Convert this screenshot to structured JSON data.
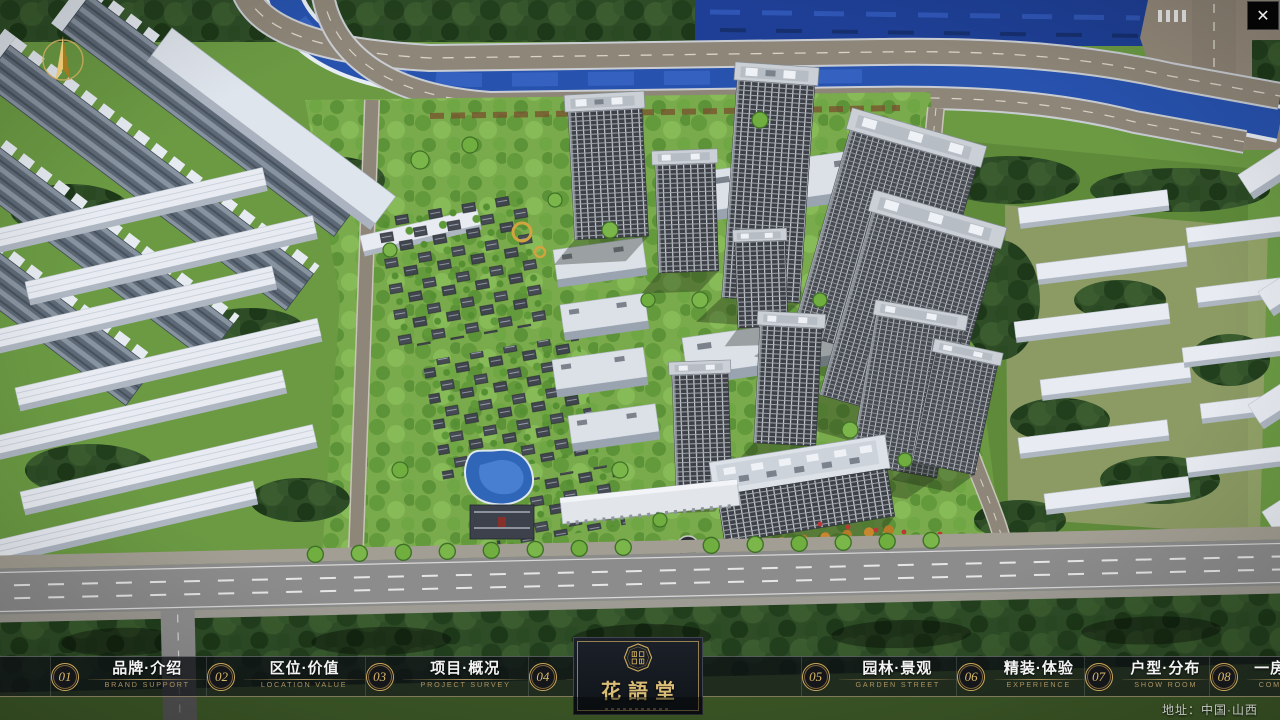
{
  "window": {
    "close_icon": "✕"
  },
  "map": {
    "address_note": "地址：中国·山西"
  },
  "logo": {
    "title": "花語堂"
  },
  "menu": {
    "items": [
      {
        "num": "01",
        "cn": "品牌·介绍",
        "en": "BRAND SUPPORT"
      },
      {
        "num": "02",
        "cn": "区位·价值",
        "en": "LOCATION VALUE"
      },
      {
        "num": "03",
        "cn": "项目·概况",
        "en": "PROJECT SURVEY"
      },
      {
        "num": "04",
        "cn": "建筑·鉴赏",
        "en": "APPRECIATION"
      },
      {
        "num": "05",
        "cn": "园林·景观",
        "en": "GARDEN STREET"
      },
      {
        "num": "06",
        "cn": "精装·体验",
        "en": "EXPERIENCE"
      },
      {
        "num": "07",
        "cn": "户型·分布",
        "en": "SHOW ROOM"
      },
      {
        "num": "08",
        "cn": "一房·一景",
        "en": "COMMUNITY"
      }
    ]
  },
  "colors": {
    "gold_accent": "#c9a85c",
    "bar_background": "rgba(13,16,20,0.78)"
  }
}
